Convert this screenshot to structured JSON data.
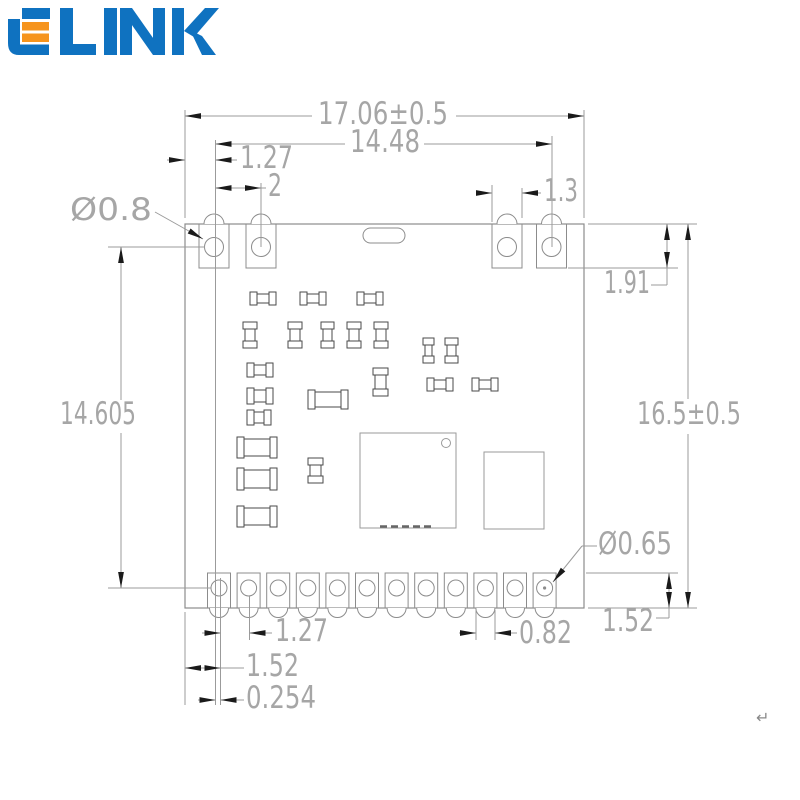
{
  "logo": {
    "text": "ELINK",
    "blue": "#0f72c0",
    "orange": "#f6941d"
  },
  "drawing": {
    "title": "RF module PCB dimension drawing",
    "labels": {
      "width_total": "17.06±0.5",
      "width_pads": "14.48",
      "offset_top_left": "1.27",
      "pitch_top": "2",
      "pad_width_right": "1.3",
      "hole_top": "Ø0.8",
      "pad_height_top": "1.91",
      "height_total": "16.5±0.5",
      "height_holes": "14.605",
      "hole_bottom": "Ø0.65",
      "pad_height_bottom": "1.52",
      "pitch_bottom": "1.27",
      "notch_bottom": "0.82",
      "offset_bottom_left": "1.52",
      "hole_offset": "0.254",
      "return_mark": "↵"
    },
    "colors": {
      "outline": "#8c8c8c",
      "component": "#4a4a4a",
      "dimension_line": "#9b9b9b",
      "dimension_text": "#a6a6a6",
      "arrow": "#1a1a1a"
    }
  }
}
